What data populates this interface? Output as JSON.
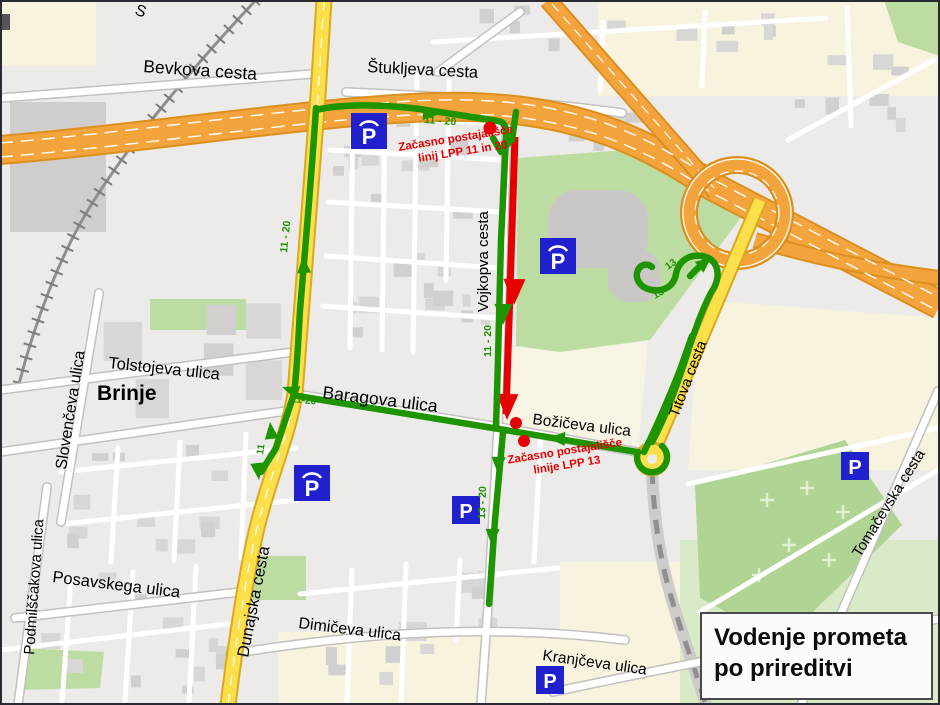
{
  "map": {
    "region_label": "Brinje",
    "partial_street": "S"
  },
  "streets": {
    "bevkova": "Bevkova cesta",
    "stukljeva": "Štukljeva cesta",
    "vojkova": "Vojkopva cesta",
    "tolstojeva": "Tolstojeva ulica",
    "baragova": "Baragova ulica",
    "bozicva": "Božičeva ulica",
    "slovenceva": "Slovenčeva ulica",
    "podmilscakova": "Podmilščakova ulica",
    "posavskega": "Posavskega ulica",
    "dunajska": "Dunajska cesta",
    "dimiceva": "Dimičeva ulica",
    "kranjceva": "Kranjčeva ulica",
    "titova": "Titova cesta",
    "tomacevska": "Tomačevska cesta"
  },
  "routes": {
    "labels": {
      "top_11_20": "11 - 20",
      "dunajska_north_11_20": "11 - 20",
      "vojkova_11_20": "11 - 20",
      "baragova_11_20": "11-20",
      "dunajska_south_11": "11",
      "south_13_20": "13 - 20",
      "bozicva_13": "13",
      "loop_upper_13": "13",
      "loop_lower_13": "13"
    },
    "colors": {
      "detour_green": "#1E9400",
      "closed_red": "#E60000"
    }
  },
  "stops": {
    "lpp_11_20": {
      "line1": "Začasno postajališče",
      "line2": "linij LPP 11 in 20"
    },
    "lpp_13": {
      "line1": "Začasno postajališče",
      "line2": "linije LPP 13"
    }
  },
  "icons": {
    "parking_letter": "P"
  },
  "title_box": {
    "line1": "Vodenje prometa",
    "line2": "po prireditvi"
  },
  "palette": {
    "road_yellow": "#FBDF4B",
    "highway_orange": "#F4A43C",
    "parking_blue": "#2020CC",
    "park_green": "#BCDCA2"
  }
}
